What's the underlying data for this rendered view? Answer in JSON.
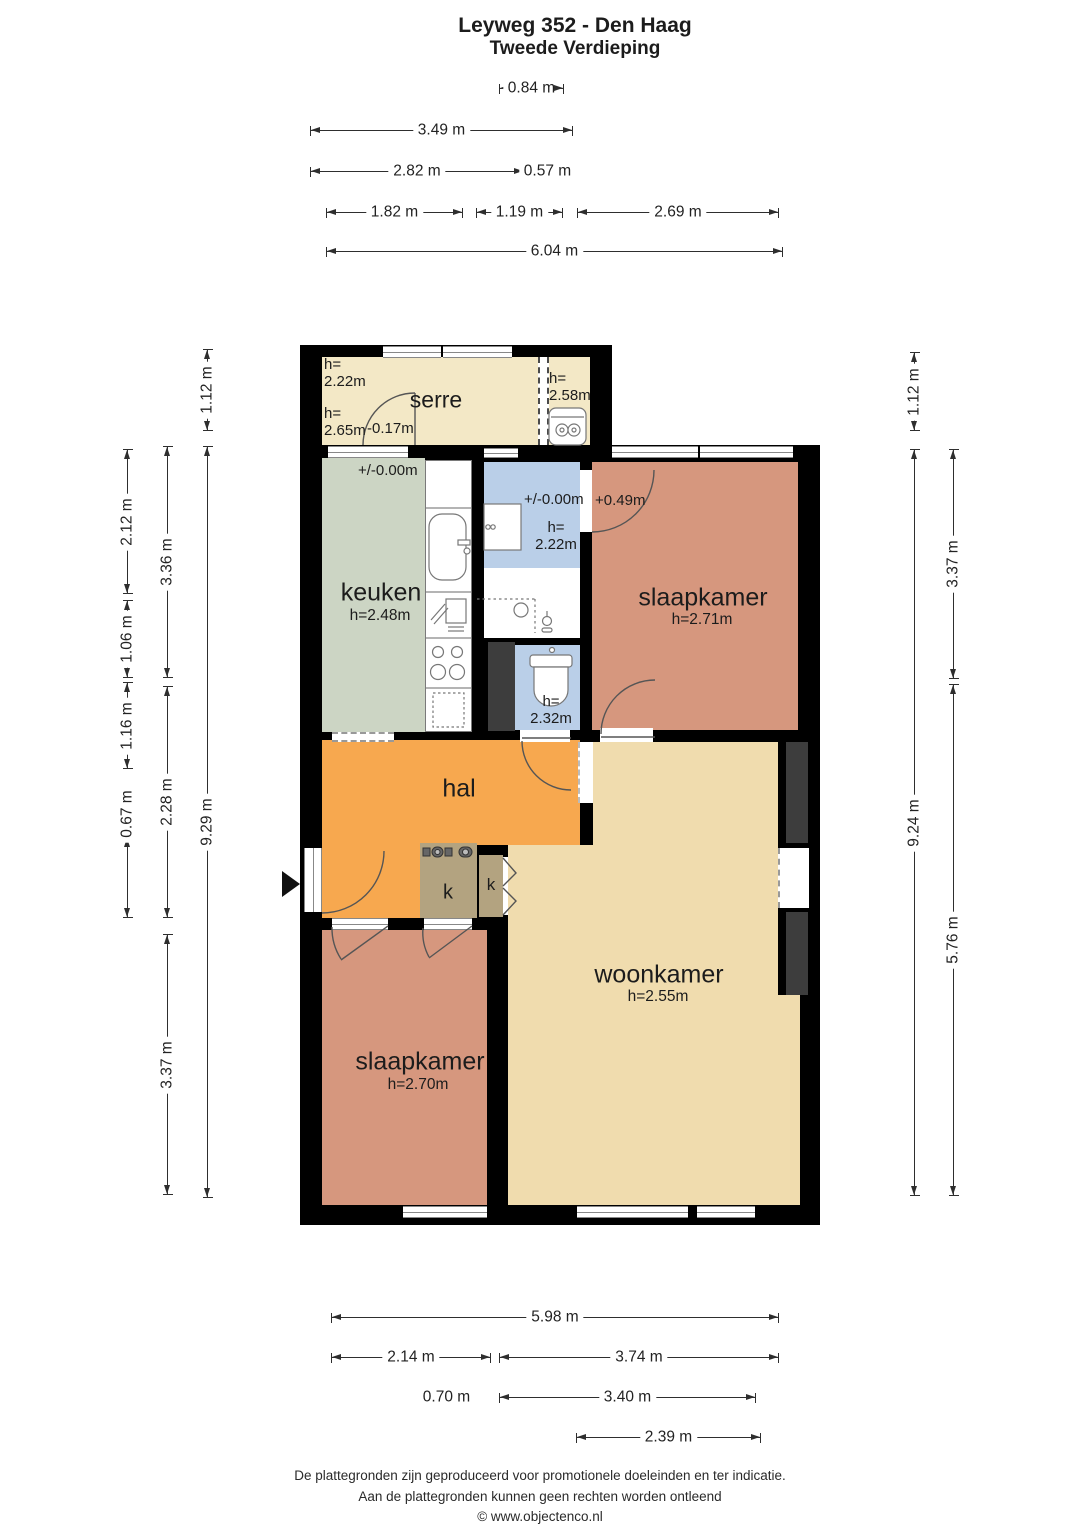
{
  "title": {
    "line1": "Leyweg 352 - Den Haag",
    "line2": "Tweede Verdieping"
  },
  "rooms": {
    "serre": {
      "name": "serre",
      "h_top_left": "h=\n2.22m",
      "h_bottom_left": "h=\n2.65m",
      "level": "-0.17m"
    },
    "boiler": {
      "h": "h=\n2.58m"
    },
    "keuken": {
      "name": "keuken",
      "h": "h=2.48m",
      "level": "+/-0.00m"
    },
    "badkamer": {
      "level": "+/-0.00m",
      "h": "h=\n2.22m"
    },
    "toilet": {
      "h": "h=\n2.32m"
    },
    "slaapkamer_1": {
      "name": "slaapkamer",
      "h": "h=2.71m",
      "level": "+0.49m"
    },
    "hal": {
      "name": "hal"
    },
    "kast_1": {
      "name": "k"
    },
    "kast_2": {
      "name": "k"
    },
    "woonkamer": {
      "name": "woonkamer",
      "h": "h=2.55m"
    },
    "slaapkamer_2": {
      "name": "slaapkamer",
      "h": "h=2.70m"
    }
  },
  "dimensions": {
    "top": [
      {
        "label": "0.84 m"
      },
      {
        "label": "3.49 m"
      },
      {
        "label": "2.82 m"
      },
      {
        "label": "0.57 m"
      },
      {
        "label": "1.82 m"
      },
      {
        "label": "1.19 m"
      },
      {
        "label": "2.69 m"
      },
      {
        "label": "6.04 m"
      }
    ],
    "bottom": [
      {
        "label": "5.98 m"
      },
      {
        "label": "2.14 m"
      },
      {
        "label": "3.74 m"
      },
      {
        "label": "0.70 m"
      },
      {
        "label": "3.40 m"
      },
      {
        "label": "2.39 m"
      }
    ],
    "left": [
      {
        "label": "1.12 m"
      },
      {
        "label": "9.29 m"
      },
      {
        "label": "3.36 m"
      },
      {
        "label": "2.28 m"
      },
      {
        "label": "3.37 m"
      },
      {
        "label": "2.12 m"
      },
      {
        "label": "1.06 m"
      },
      {
        "label": "1.16 m"
      },
      {
        "label": "0.67 m"
      }
    ],
    "right": [
      {
        "label": "1.12 m"
      },
      {
        "label": "9.24 m"
      },
      {
        "label": "3.37 m"
      },
      {
        "label": "5.76 m"
      }
    ]
  },
  "footer": {
    "line1": "De plattegronden zijn geproduceerd voor promotionele doeleinden en ter indicatie.",
    "line2": "Aan de plattegronden kunnen geen rechten worden ontleend",
    "line3": "© www.objectenco.nl"
  },
  "colors": {
    "wall": "#000000",
    "serre_floor": "#f3e8c6",
    "kitchen_floor": "#ccd5c4",
    "bathroom_floor": "#bacfe8",
    "hall_floor": "#f7a84f",
    "bedroom_floor": "#d6977e",
    "living_floor": "#f0dcae",
    "closet_floor": "#b3a380",
    "shaft": "#3d3d3d"
  }
}
